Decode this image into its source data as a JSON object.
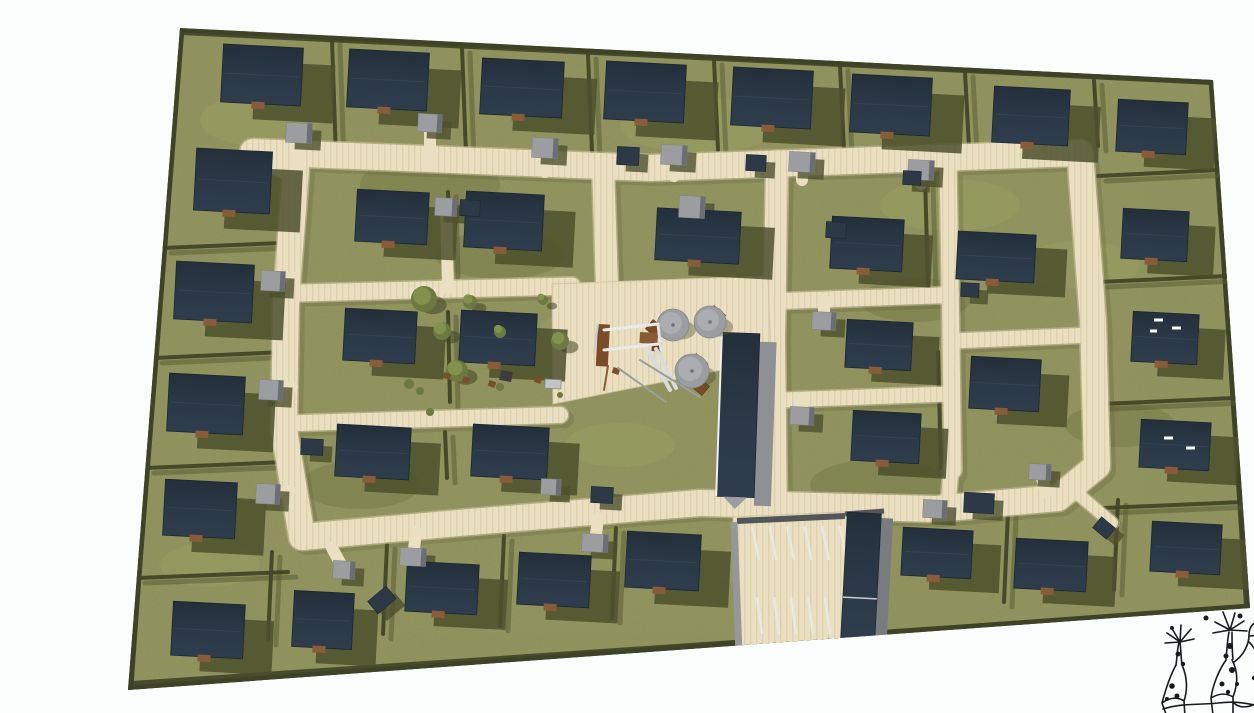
{
  "meta": {
    "title": "Residential site plan rendering",
    "description": "Aerial 3D rendering of a residential development: rows of dark-roofed houses on olive lawns, a cream street loop, central green with playground and parasols, a long communal building, a striped parking court, and a hand-drawn tree-creature sketch logo in the lower right corner."
  },
  "palette": {
    "bg": "#fbfcfc",
    "grass": "#8a8d55",
    "grassLight": "#9aa161",
    "grassDark": "#6d7240",
    "hedge": "#424628",
    "hedgeShadow": "#565a33",
    "boundary": "#3f4428",
    "road": "#eadfc1",
    "roadStripe": "#ddd0ad",
    "roadEdge": "#d2c5a2",
    "roadShadow": "#5a5e38",
    "roof": "#2b3947",
    "roofDark": "#232f3b",
    "roofLow": "#2e3d4c",
    "roofEdge": "#1c2731",
    "shadow": "#4c502c",
    "garage": "#9b9da0",
    "garageSide": "#6b6e74",
    "shed": "#2c3a48",
    "step": "#8a5b39",
    "wall": "#95979a",
    "wallDark": "#54555a",
    "stripe": "#e8e9e6",
    "parasol": "#9b9ea0",
    "parasolLight": "#abaeb0",
    "table": "#7c4a26",
    "wood": "#8a5a33",
    "woodDark": "#7a4d28",
    "treeFill": "#6b7a3f",
    "treeLight": "#82914b",
    "metal": "#d8dcdd",
    "shadowLine": "#9aa09f",
    "car": "#c2c5c6",
    "item": "#7c4e28",
    "darkItem": "#3a3d40",
    "ink": "#1a1a1e",
    "white": "#ffffff"
  },
  "site": {
    "outline": [
      [
        180,
        28
      ],
      [
        1213,
        80
      ],
      [
        1250,
        608
      ],
      [
        128,
        690
      ]
    ],
    "boundaryLines": [
      [
        176,
        36,
        129,
        686,
        9
      ],
      [
        182,
        32,
        1212,
        82,
        6
      ],
      [
        132,
        686,
        1248,
        610,
        10
      ],
      [
        1213,
        84,
        1247,
        606,
        6
      ]
    ]
  },
  "grassPatches": [
    [
      260,
      120,
      60,
      26,
      1
    ],
    [
      430,
      185,
      70,
      30,
      0
    ],
    [
      700,
      125,
      80,
      28,
      1
    ],
    [
      950,
      205,
      70,
      26,
      1
    ],
    [
      360,
      485,
      60,
      24,
      0
    ],
    [
      620,
      445,
      55,
      22,
      1
    ],
    [
      880,
      485,
      70,
      26,
      0
    ],
    [
      1080,
      265,
      60,
      24,
      1
    ],
    [
      500,
      255,
      65,
      24,
      0
    ],
    [
      770,
      565,
      60,
      22,
      1
    ],
    [
      1120,
      425,
      55,
      22,
      0
    ],
    [
      210,
      565,
      50,
      22,
      1
    ],
    [
      585,
      330,
      45,
      20,
      1
    ],
    [
      915,
      300,
      55,
      22,
      0
    ]
  ],
  "hedges": [
    [
      332,
      40,
      336,
      158
    ],
    [
      462,
      48,
      466,
      154
    ],
    [
      588,
      54,
      592,
      152
    ],
    [
      714,
      60,
      718,
      150
    ],
    [
      840,
      66,
      844,
      150
    ],
    [
      965,
      72,
      969,
      148
    ],
    [
      1094,
      80,
      1098,
      146
    ],
    [
      163,
      248,
      282,
      243
    ],
    [
      154,
      358,
      284,
      352
    ],
    [
      146,
      468,
      286,
      462
    ],
    [
      137,
      578,
      288,
      572
    ],
    [
      272,
      552,
      268,
      640
    ],
    [
      387,
      544,
      383,
      634
    ],
    [
      504,
      536,
      500,
      626
    ],
    [
      616,
      528,
      612,
      618
    ],
    [
      1008,
      512,
      1004,
      602
    ],
    [
      1118,
      500,
      1114,
      590
    ],
    [
      1098,
      176,
      1219,
      170
    ],
    [
      1100,
      282,
      1227,
      276
    ],
    [
      1102,
      404,
      1235,
      398
    ],
    [
      1104,
      508,
      1243,
      502
    ],
    [
      448,
      192,
      450,
      272
    ],
    [
      448,
      312,
      450,
      402
    ],
    [
      445,
      432,
      447,
      478
    ],
    [
      925,
      175,
      928,
      288
    ],
    [
      938,
      352,
      941,
      468
    ]
  ],
  "roads": [
    {
      "pts": [
        [
          253,
          152
        ],
        [
          650,
          168
        ],
        [
          1080,
          153
        ],
        [
          1093,
          320
        ],
        [
          1097,
          466
        ],
        [
          1058,
          498
        ],
        [
          936,
          509
        ],
        [
          700,
          503
        ],
        [
          470,
          522
        ],
        [
          302,
          537
        ],
        [
          284,
          430
        ],
        [
          286,
          300
        ],
        [
          296,
          170
        ],
        [
          253,
          152
        ]
      ],
      "w": 26
    },
    {
      "pts": [
        [
          603,
          166
        ],
        [
          607,
          286
        ]
      ],
      "w": 22
    },
    {
      "pts": [
        [
          777,
          162
        ],
        [
          774,
          340
        ],
        [
          776,
          505
        ]
      ],
      "w": 22
    },
    {
      "pts": [
        [
          300,
          293
        ],
        [
          572,
          286
        ]
      ],
      "w": 17
    },
    {
      "pts": [
        [
          300,
          423
        ],
        [
          560,
          415
        ]
      ],
      "w": 16
    },
    {
      "pts": [
        [
          948,
          158
        ],
        [
          953,
          470
        ]
      ],
      "w": 17
    },
    {
      "pts": [
        [
          782,
          301
        ],
        [
          950,
          295
        ]
      ],
      "w": 16
    },
    {
      "pts": [
        [
          952,
          341
        ],
        [
          1092,
          335
        ]
      ],
      "w": 15
    },
    {
      "pts": [
        [
          782,
          400
        ],
        [
          950,
          394
        ]
      ],
      "w": 15
    },
    {
      "pts": [
        [
          951,
          468
        ],
        [
          948,
          507
        ]
      ],
      "w": 15
    },
    {
      "pts": [
        [
          1078,
          494
        ],
        [
          1112,
          523
        ]
      ],
      "w": 12
    }
  ],
  "plaza": [
    [
      552,
      284
    ],
    [
      768,
      276
    ],
    [
      771,
      360
    ],
    [
      553,
      404
    ]
  ],
  "parking": {
    "lot": [
      [
        733,
        517
      ],
      [
        884,
        510
      ],
      [
        887,
        657
      ],
      [
        737,
        661
      ]
    ],
    "walls": [
      [
        737,
        521,
        845,
        516,
        6,
        "wallDark"
      ],
      [
        734,
        522,
        739,
        654,
        7,
        "wall"
      ],
      [
        845,
        514,
        884,
        511,
        5,
        "wallDark"
      ]
    ],
    "stripeRows": [
      {
        "x": 752,
        "y": 526,
        "n": 6,
        "dx": 17.5,
        "len": 34,
        "slant": 7
      },
      {
        "x": 757,
        "y": 597,
        "n": 6,
        "dx": 17,
        "len": 37,
        "slant": 5
      }
    ]
  },
  "houses": {
    "rot": 3,
    "shadowFactor": [
      0.4,
      0.3
    ],
    "list": [
      [
        262,
        75,
        80,
        58
      ],
      [
        388,
        80,
        80,
        58
      ],
      [
        522,
        88,
        82,
        56
      ],
      [
        645,
        92,
        80,
        58
      ],
      [
        772,
        98,
        80,
        58
      ],
      [
        891,
        105,
        80,
        58
      ],
      [
        1031,
        116,
        76,
        56
      ],
      [
        1152,
        127,
        70,
        52
      ],
      [
        1155,
        235,
        66,
        50
      ],
      [
        1165,
        338,
        66,
        50
      ],
      [
        1175,
        445,
        70,
        48
      ],
      [
        1186,
        548,
        70,
        50
      ],
      [
        233,
        181,
        76,
        62
      ],
      [
        214,
        292,
        78,
        58
      ],
      [
        206,
        404,
        76,
        58
      ],
      [
        200,
        509,
        72,
        56
      ],
      [
        208,
        630,
        72,
        54
      ],
      [
        323,
        620,
        60,
        56
      ],
      [
        442,
        588,
        72,
        50
      ],
      [
        554,
        580,
        72,
        52
      ],
      [
        663,
        561,
        74,
        56
      ],
      [
        937,
        553,
        70,
        48
      ],
      [
        1051,
        565,
        72,
        50
      ],
      [
        392,
        217,
        72,
        52
      ],
      [
        504,
        221,
        78,
        56
      ],
      [
        380,
        336,
        72,
        52
      ],
      [
        498,
        338,
        76,
        52
      ],
      [
        373,
        452,
        74,
        52
      ],
      [
        510,
        452,
        76,
        52
      ],
      [
        698,
        236,
        84,
        52
      ],
      [
        867,
        244,
        72,
        52
      ],
      [
        996,
        257,
        78,
        48
      ],
      [
        879,
        345,
        66,
        48
      ],
      [
        1005,
        384,
        70,
        52
      ],
      [
        886,
        437,
        68,
        50
      ]
    ]
  },
  "garages": [
    [
      299,
      133,
      26,
      20,
      299,
      170
    ],
    [
      430,
      123,
      24,
      18,
      430,
      166
    ],
    [
      545,
      148,
      26,
      20,
      545,
      172
    ],
    [
      674,
      155,
      26,
      20,
      674,
      176
    ],
    [
      802,
      162,
      26,
      20,
      802,
      180
    ],
    [
      921,
      170,
      26,
      20,
      921,
      184
    ],
    [
      273,
      281,
      24,
      20,
      294,
      278
    ],
    [
      271,
      390,
      24,
      20,
      292,
      387
    ],
    [
      268,
      494,
      24,
      20,
      290,
      491
    ],
    [
      413,
      557,
      26,
      18,
      416,
      532
    ],
    [
      595,
      543,
      26,
      18,
      598,
      518
    ],
    [
      344,
      570,
      22,
      18,
      332,
      548
    ],
    [
      446,
      207,
      22,
      18,
      448,
      288
    ],
    [
      692,
      207,
      26,
      22,
      0,
      0
    ],
    [
      824,
      321,
      24,
      18,
      824,
      300
    ],
    [
      802,
      416,
      24,
      18,
      802,
      398
    ],
    [
      1040,
      472,
      22,
      16,
      1046,
      492
    ],
    [
      935,
      509,
      24,
      18,
      0,
      0
    ],
    [
      551,
      487,
      20,
      16,
      0,
      0
    ]
  ],
  "sheds": [
    [
      628,
      156,
      22,
      18,
      3
    ],
    [
      756,
      163,
      20,
      16,
      3
    ],
    [
      470,
      208,
      20,
      16,
      3
    ],
    [
      912,
      178,
      18,
      14,
      3
    ],
    [
      979,
      503,
      30,
      20,
      3
    ],
    [
      312,
      447,
      22,
      16,
      3
    ],
    [
      836,
      230,
      20,
      16,
      3
    ],
    [
      1104,
      528,
      18,
      14,
      40
    ],
    [
      382,
      600,
      24,
      16,
      -40
    ],
    [
      602,
      495,
      22,
      16,
      3
    ],
    [
      970,
      290,
      18,
      14,
      3
    ]
  ],
  "longBuilding": {
    "x": 738,
    "y": 415,
    "w": 38,
    "h": 164,
    "r": 2
  },
  "parkBuilding": {
    "x": 861,
    "y": 577,
    "w": 34,
    "h": 128,
    "r": 3
  },
  "roofMarks": [
    [
      1154,
      320,
      1163,
      320
    ],
    [
      1172,
      328,
      1181,
      328
    ],
    [
      1164,
      438,
      1173,
      438
    ],
    [
      1186,
      448,
      1195,
      448
    ],
    [
      1150,
      331,
      1157,
      331
    ]
  ],
  "trees": [
    [
      424,
      299,
      13
    ],
    [
      442,
      331,
      9
    ],
    [
      457,
      371,
      11
    ],
    [
      560,
      341,
      9
    ],
    [
      470,
      302,
      7
    ],
    [
      543,
      300,
      5
    ],
    [
      500,
      332,
      6
    ]
  ],
  "shrubs": [
    [
      409,
      384,
      5
    ],
    [
      420,
      391,
      4
    ],
    [
      500,
      387,
      4
    ],
    [
      548,
      383,
      4
    ],
    [
      430,
      412,
      4
    ],
    [
      560,
      395,
      3
    ]
  ],
  "gardenItems": [
    [
      447,
      376
    ],
    [
      466,
      380
    ],
    [
      492,
      384
    ],
    [
      538,
      380
    ],
    [
      616,
      371
    ]
  ],
  "darkItem": [
    506,
    376,
    12,
    10
  ],
  "car": [
    553,
    384,
    16,
    9
  ],
  "tables": [
    [
      655,
      329
    ],
    [
      716,
      315
    ],
    [
      698,
      363
    ],
    [
      700,
      386
    ]
  ],
  "parasols": [
    [
      673,
      325,
      16
    ],
    [
      710,
      322,
      16
    ],
    [
      692,
      371,
      17
    ]
  ],
  "playground": {
    "rects": [
      [
        598,
        324,
        12,
        42,
        3,
        "#7a4d28"
      ],
      [
        640,
        332,
        18,
        11,
        3,
        "#8a5a33"
      ],
      [
        652,
        342,
        10,
        9,
        3,
        "#6f4522"
      ]
    ],
    "lines": [
      [
        604,
        330,
        658,
        324,
        3,
        "#e8ebec"
      ],
      [
        604,
        350,
        658,
        344,
        3,
        "#e8ebec"
      ],
      [
        658,
        324,
        661,
        350,
        3,
        "#dfe3e4"
      ],
      [
        648,
        350,
        670,
        390,
        4,
        "#d8dcdd"
      ],
      [
        656,
        349,
        676,
        388,
        4,
        "#d8dcdd"
      ],
      [
        640,
        360,
        700,
        397,
        2,
        "#9aa09f"
      ],
      [
        618,
        368,
        666,
        402,
        2,
        "#9aa09f"
      ],
      [
        598,
        324,
        594,
        352,
        2,
        "#c9ccce"
      ],
      [
        608,
        366,
        604,
        390,
        2,
        "#8a5a33"
      ]
    ]
  },
  "logo": {
    "x": 1142,
    "y": 596,
    "strokeWidth": 1.6,
    "paths": [
      "M38,46 l-13,-9 m13,9 l-15,1 m15,-1 l-9,-15 m9,15 l1,-17 m-1,17 l11,-13 m-11,13 l14,-3",
      "M88,34 l-15,-8 m15,8 l-17,3 m17,-3 l-7,-18 m7,18 l5,-17 m-5,17 l14,-9 m-14,9 l17,1",
      "M37,46 c-2,9 -2,16 -3,23 m4,-23 c1,9 1,16 2,23",
      "M34,69 C29,78 24,92 20,107 L25,121 M20,107 C28,101 36,101 42,105 L43,121 M42,105 C46,93 45,80 40,69",
      "M87,36 c-2,10 -2,19 -3,27 m6,-27 c0,10 0,19 1,27",
      "M84,64 C77,74 71,88 69,102 L71,119 M69,102 C77,97 85,97 91,101 L91,119 M91,101 C96,88 96,75 90,64",
      "M92,66 C101,60 107,49 107,39 C107,30 113,24 119,27 C125,30 123,38 117,39 L108,40 M107,46 C113,52 119,62 121,74 C123,88 119,101 113,108 L117,121 M113,108 C105,112 97,112 92,107",
      "M117,27 l9,-5 m-7,9 l11,-3 m-11,7 l10,1",
      "M21,113 C40,107 58,109 76,107 C92,105 104,107 112,109"
    ],
    "dots": [
      [
        36,
        58,
        2.5
      ],
      [
        41,
        68,
        2.2
      ],
      [
        30,
        90,
        2.8
      ],
      [
        35,
        100,
        2.5
      ],
      [
        25,
        103,
        2
      ],
      [
        88,
        50,
        3
      ],
      [
        84,
        60,
        2.5
      ],
      [
        90,
        74,
        3
      ],
      [
        80,
        88,
        2.5
      ],
      [
        86,
        96,
        2.2
      ],
      [
        95,
        88,
        2
      ],
      [
        112,
        82,
        2.2
      ],
      [
        64,
        22,
        2.5
      ],
      [
        98,
        20,
        2.5
      ],
      [
        30,
        32,
        2
      ]
    ]
  }
}
